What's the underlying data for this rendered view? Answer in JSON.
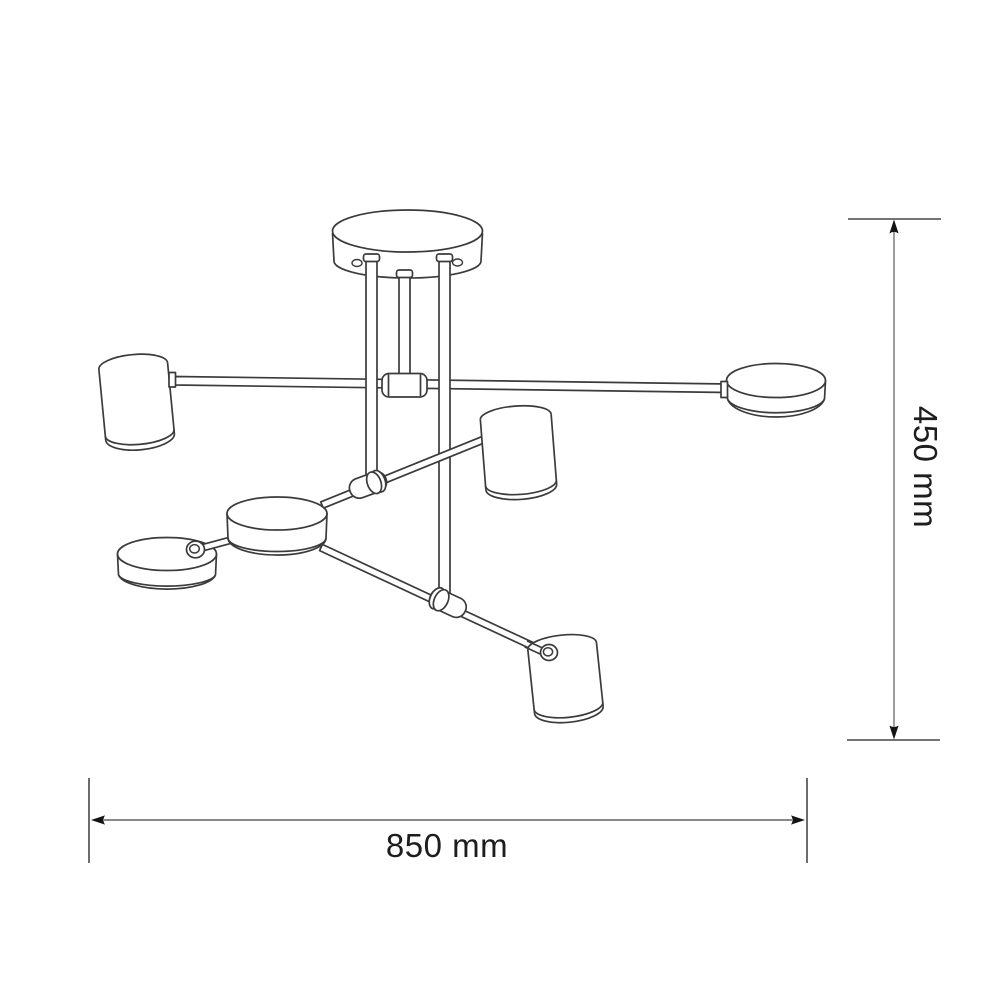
{
  "page": {
    "background": "#ffffff",
    "subject": "technical line drawing of a six-head ceiling lamp with dimension callouts"
  },
  "dimensions": {
    "height_label": "450 mm",
    "width_label": "850 mm"
  },
  "colors": {
    "drawing_stroke": "#3b3b3b",
    "dimension_line_vertical": "#9e9e9e",
    "dimension_line_horizontal": "#787878",
    "extension_line": "#474747",
    "arrow": "#141414",
    "dimension_text": "#1d1d1d",
    "fill": "#ffffff"
  }
}
